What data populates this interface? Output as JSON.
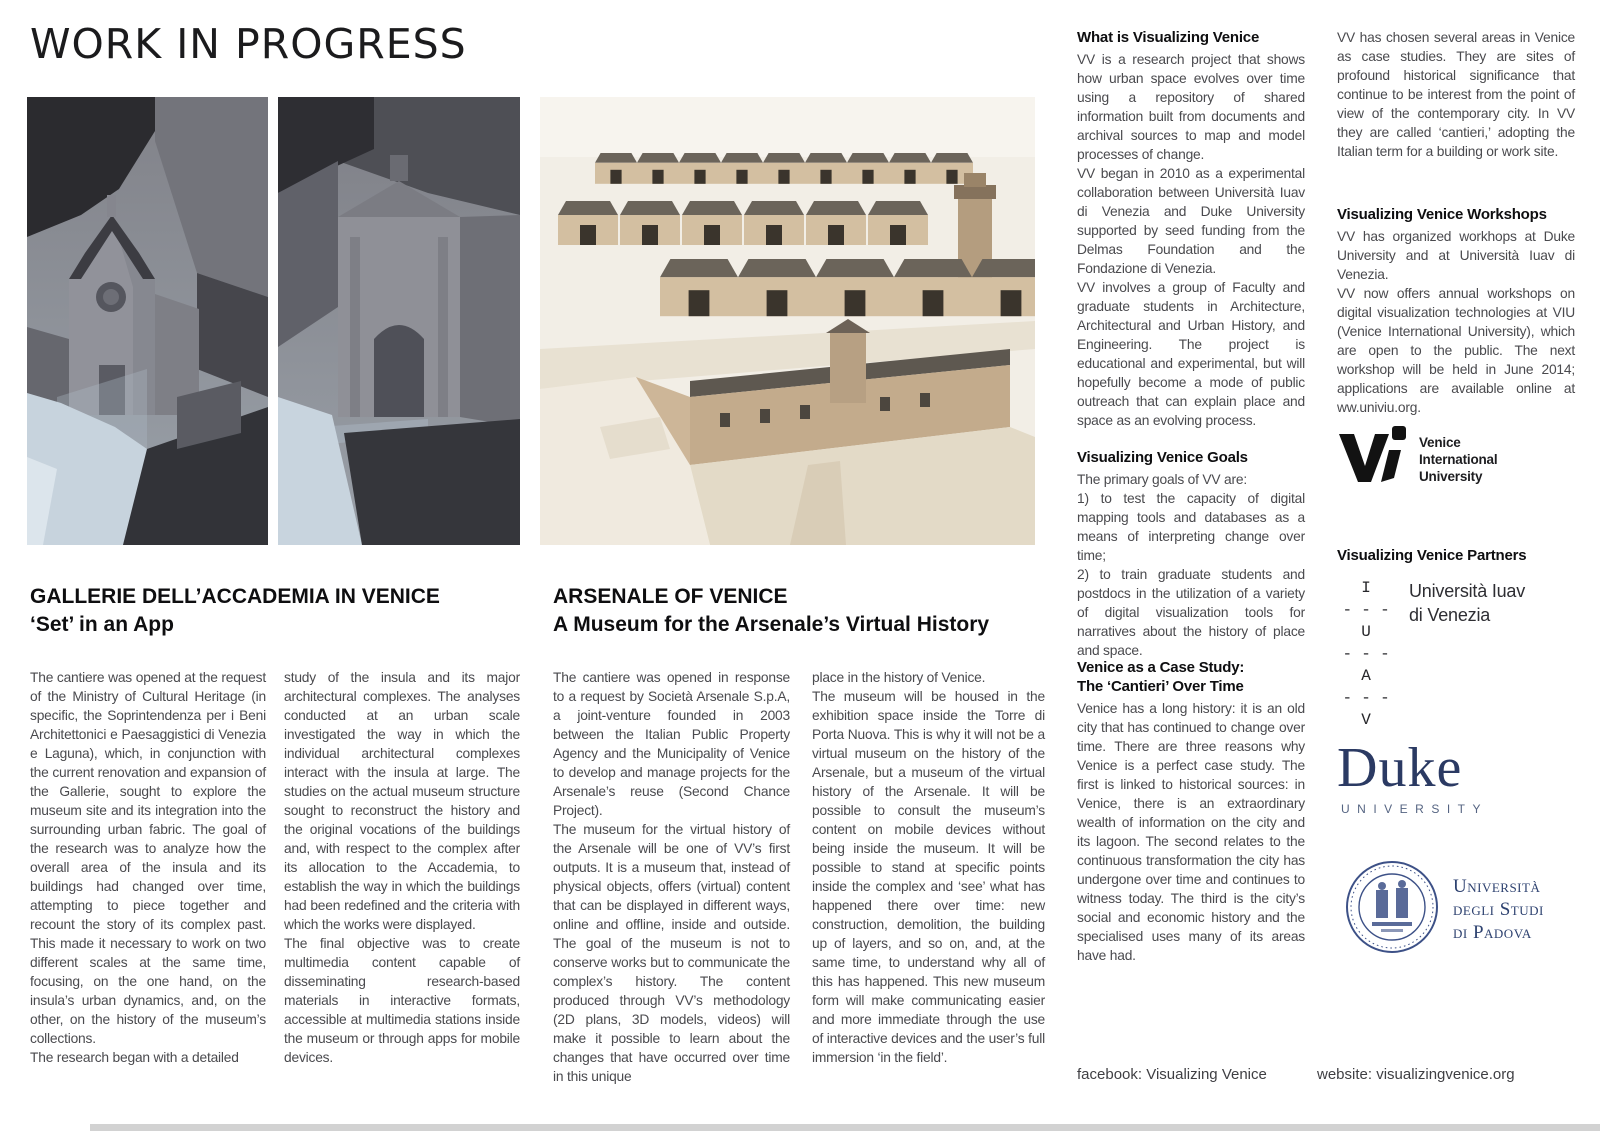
{
  "page": {
    "title": "WORK IN PROGRESS",
    "footer": {
      "facebook": "facebook: Visualizing Venice",
      "website": "website: visualizingvenice.org"
    }
  },
  "colors": {
    "duke_navy": "#2b3a63",
    "padova_navy": "#2e4270",
    "body_text": "#4a4a4e",
    "render_ground_blue": "#c7d3dd",
    "render_tan": "#c9b295"
  },
  "figures": {
    "accademia_render_1": "3D model render of the Gallerie dell'Accademia church complex",
    "accademia_render_2": "3D model render of the Accademia facade",
    "arsenale_render": "3D model render of the Arsenale of Venice complex"
  },
  "accademia": {
    "title": "GALLERIE DELL’ACCADEMIA IN VENICE",
    "subtitle": "‘Set’ in an App",
    "col1": [
      "The cantiere was opened at the request of the Ministry of Cultural Heritage (in specific, the Soprintendenza per i Beni Architettonici e Paesaggistici di Venezia e Laguna), which, in conjunction with the current renovation and expansion of the Gallerie, sought to explore the museum site and its integration into the surrounding urban fabric. The goal of the research was to analyze how the overall area of the insula and its buildings had changed over time, attempting to piece together and recount the story of its complex past. This made it necessary to work on two different scales at the same time, focusing, on the one hand, on the insula’s urban dynamics, and, on the other, on the history of the museum’s collections.",
      "The research began with a detailed"
    ],
    "col2": [
      "study of the insula and its major architectural complexes. The analyses conducted at an urban scale investigated the way in which the individual architectural complexes interact with the insula at large. The studies on the actual museum structure sought to reconstruct the history and the original vocations of the buildings and, with respect to the complex after its allocation to the Accademia, to establish the way in which the buildings had been redefined and the criteria with which the works were displayed.",
      "The final objective was to create multimedia content capable of disseminating research-based materials in interactive formats, accessible at multimedia stations inside the museum or through apps for mobile devices."
    ]
  },
  "arsenale": {
    "title": "ARSENALE OF VENICE",
    "subtitle": "A Museum for the Arsenale’s Virtual History",
    "col1": [
      "The cantiere was opened in response to a request by Società Arsenale S.p.A, a joint-venture founded in 2003 between the Italian Public Property Agency and the Municipality of Venice to develop and manage projects for the Arsenale’s reuse (Second Chance Project).",
      "The museum for the virtual history of the Arsenale will be one of VV’s first outputs. It is a museum that, instead of physical objects, offers (virtual) content that can be displayed in different ways, online and offline, inside and outside. The goal of the museum is not to conserve works but to communicate the complex’s history. The content produced through VV’s methodology (2D plans, 3D models, videos) will make it possible to learn about the changes that have occurred over time in this unique"
    ],
    "col2": [
      "place in the history of Venice.",
      "The museum will be housed in the exhibition space inside the Torre di Porta Nuova. This is why it will not be a virtual museum on the history of the Arsenale, but a museum of the virtual history of the Arsenale. It will be possible to consult the museum’s content on mobile devices without being inside the museum. It will be possible to stand at specific points inside the complex and ‘see’ what has happened there over time: new construction, demolition, the building up of layers, and so on, and, at the same time, to understand why all of this has happened. This new museum form will make communicating easier and more immediate through the use of interactive devices and the user’s full immersion ‘in the field’."
    ]
  },
  "sidebar": {
    "what": {
      "heading": "What is Visualizing Venice",
      "paras": [
        "VV is a research project that shows how urban space evolves over time using a repository of shared information built from documents and archival sources to map and model processes of change.",
        "VV began in 2010 as a experimental collaboration between Università Iuav di Venezia and Duke University supported by seed funding from the Delmas Foundation and the Fondazione di Venezia.",
        "VV involves a group of Faculty and graduate students in Architecture, Architectural and Urban History, and Engineering. The project is educational and experimental, but will hopefully become a mode of public outreach that can explain place and space as an evolving process."
      ]
    },
    "goals": {
      "heading": "Visualizing Venice Goals",
      "lines": [
        "The primary goals of VV are:",
        "1) to test the capacity of digital mapping tools and databases as a means of interpreting change over time;",
        "2) to train graduate students and postdocs in the utilization of a variety of digital visualization tools for narratives about the history of place and space."
      ]
    },
    "case": {
      "heading1": "Venice as a Case Study:",
      "heading2": "The ‘Cantieri’ Over Time",
      "para": "Venice has a long history: it is an old city that has continued to change over time. There are three reasons why Venice is a perfect case study. The first is linked to historical sources: in Venice, there is an extraordinary wealth of information on the city and its lagoon. The second relates to the continuous transformation the city has undergone over time and continues to witness today. The third is the city’s social and economic history and the specialised uses many of its areas have had."
    }
  },
  "rightcol": {
    "intro": "VV has chosen several areas in Venice as case studies. They are sites of profound historical significance that continue to be interest from the point of view of the contemporary city. In VV they are called ‘cantieri,’ adopting the Italian term for a building or work site.",
    "workshops": {
      "heading": "Visualizing Venice Workshops",
      "paras": [
        "VV has organized workhops at Duke University and at Università Iuav di Venezia.",
        "VV now offers annual workshops on digital visualization technologies at VIU (Venice International University), which are open to the public. The next workshop will be held in June 2014; applications are available online at ww.univiu.org."
      ]
    },
    "viu": {
      "line1": "Venice",
      "line2": "International",
      "line3": "University"
    },
    "partners_heading": "Visualizing Venice Partners",
    "iuav": {
      "letter1": "I",
      "letter2": "U",
      "letter3": "A",
      "letter4": "V",
      "dashes": "- - -",
      "name1": "Università Iuav",
      "name2": "di Venezia"
    },
    "duke": {
      "wordmark": "Duke",
      "sub": "UNIVERSITY"
    },
    "padova": {
      "line1": "Università",
      "line2": "degli Studi",
      "line3": "di Padova"
    }
  }
}
